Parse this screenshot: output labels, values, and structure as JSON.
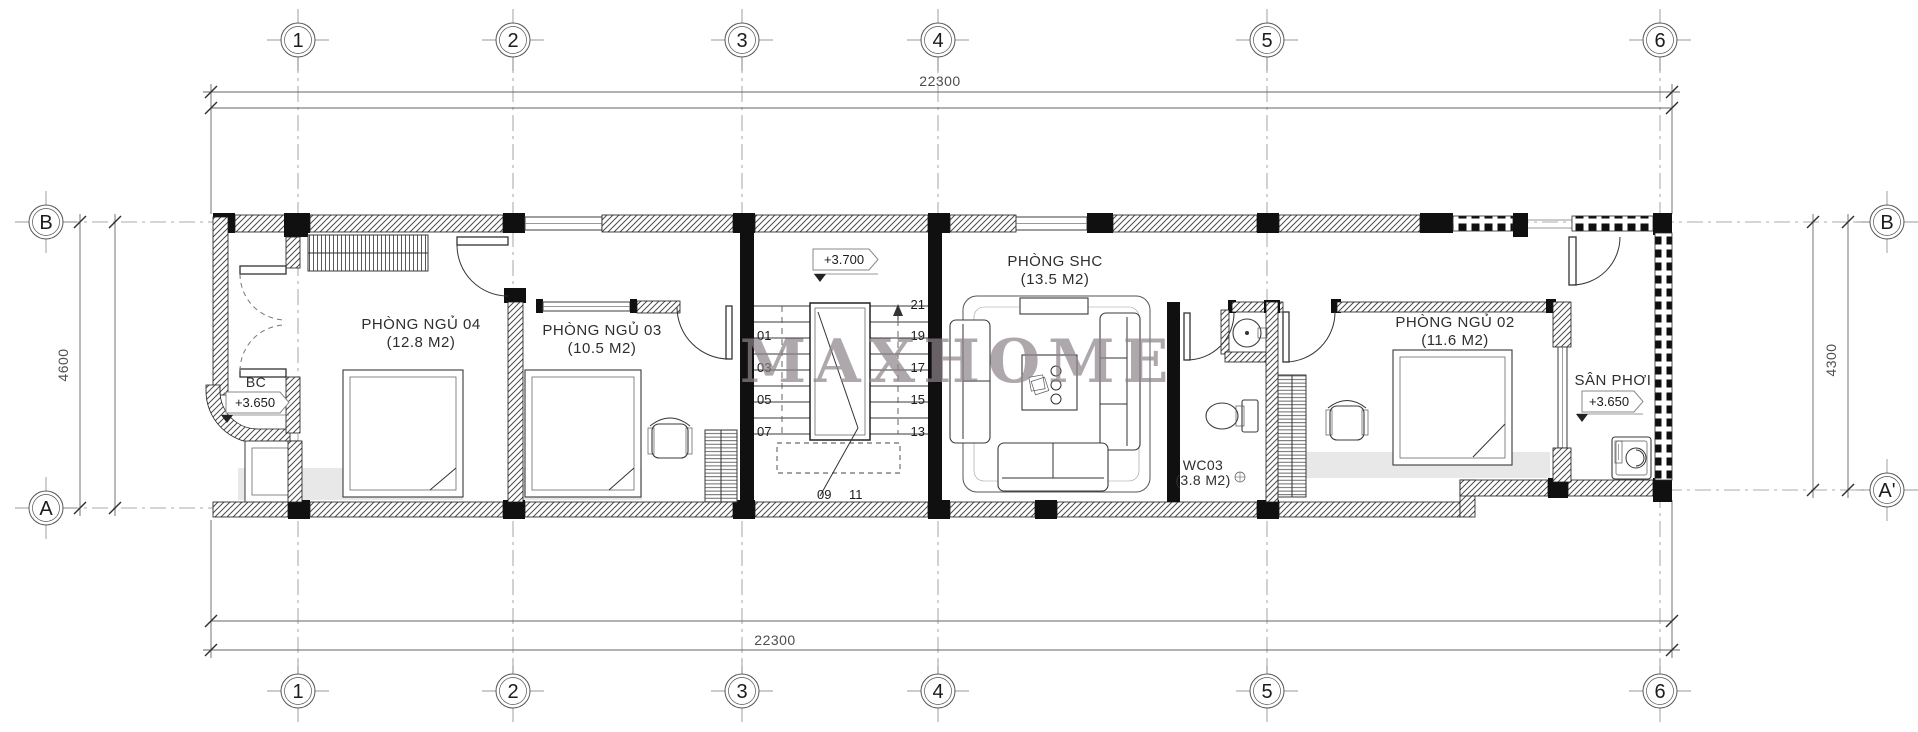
{
  "watermark": "MAXHOME",
  "grid": {
    "top": [
      "1",
      "2",
      "3",
      "4",
      "5",
      "6"
    ],
    "bottom": [
      "1",
      "2",
      "3",
      "4",
      "5",
      "6"
    ],
    "left": [
      "B",
      "A"
    ],
    "right": [
      "B",
      "A'"
    ]
  },
  "dimensions": {
    "top": "22300",
    "bottom": "22300",
    "left": "4600",
    "right": "4300"
  },
  "rooms": {
    "bedroom4": {
      "name": "PHÒNG NGỦ 04",
      "area": "(12.8 M2)"
    },
    "bedroom3": {
      "name": "PHÒNG NGỦ 03",
      "area": "(10.5 M2)"
    },
    "family": {
      "name": "PHÒNG SHC",
      "area": "(13.5 M2)"
    },
    "bedroom2": {
      "name": "PHÒNG NGỦ 02",
      "area": "(11.6 M2)"
    },
    "wc": {
      "name": "WC03",
      "area": "(3.8 M2)"
    },
    "laundry": {
      "name": "SÂN PHƠI",
      "level": "+3.650"
    },
    "balcony": {
      "name": "BC",
      "level": "+3.650"
    }
  },
  "stair_level": "+3.700",
  "stairs": {
    "left": [
      "01",
      "03",
      "05",
      "07"
    ],
    "right": [
      "21",
      "19",
      "17",
      "15",
      "13"
    ],
    "bottom": [
      "09",
      "11"
    ]
  }
}
